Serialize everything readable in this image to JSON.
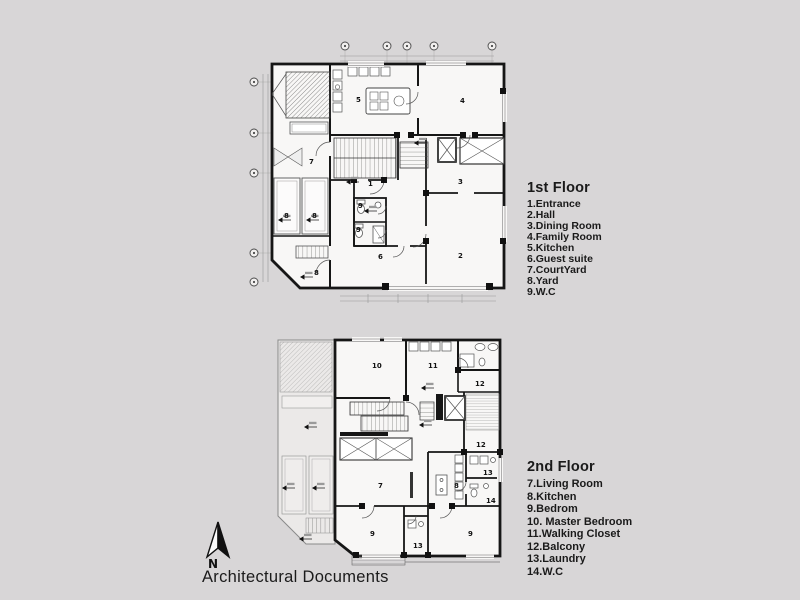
{
  "page": {
    "background": "#d8d6d7",
    "wall_color": "#161616",
    "title": "Architectural Documents"
  },
  "north": {
    "label": "N"
  },
  "legend_first": {
    "title": "1st Floor",
    "items": [
      "1.Entrance",
      "2.Hall",
      "3.Dining Room",
      "4.Family Room",
      "5.Kitchen",
      "6.Guest suite",
      "7.CourtYard",
      "8.Yard",
      "9.W.C"
    ]
  },
  "legend_second": {
    "title": "2nd Floor",
    "items": [
      "7.Living Room",
      "8.Kitchen",
      "9.Bedrom",
      "10. Master Bedroom",
      "11.Walking Closet",
      "12.Balcony",
      "13.Laundry",
      "14.W.C"
    ]
  },
  "plan_first": {
    "rooms": {
      "entrance": "1",
      "hall": "2",
      "dining": "3",
      "family": "4",
      "kitchen": "5",
      "guest": "6",
      "courtyard": "7",
      "yard_a": "8",
      "yard_b": "8",
      "yard_c": "8",
      "wc_a": "9",
      "wc_b": "9"
    }
  },
  "plan_second": {
    "rooms": {
      "living": "7",
      "kitchen": "8",
      "bedroom_a": "9",
      "bedroom_b": "9",
      "master": "10",
      "closet": "11",
      "balcony_a": "12",
      "balcony_b": "12",
      "laundry_a": "13",
      "laundry_b": "13",
      "wc": "14"
    }
  }
}
